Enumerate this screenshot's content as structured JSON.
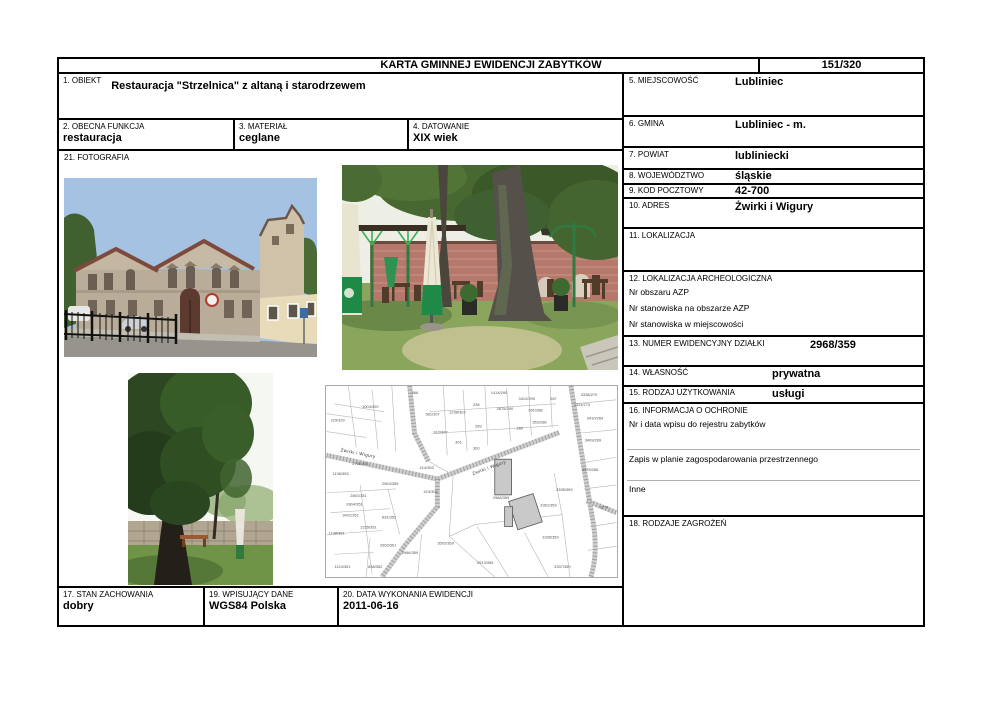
{
  "header": {
    "title": "KARTA GMINNEJ EWIDENCJI ZABYTKÓW",
    "page_number": "151/320"
  },
  "fields": {
    "obiekt": {
      "label": "1. OBIEKT",
      "value": "Restauracja \"Strzelnica\" z altaną i starodrzewem"
    },
    "obecna_funkcja": {
      "label": "2. OBECNA FUNKCJA",
      "value": "restauracja"
    },
    "material": {
      "label": "3. MATERIAŁ",
      "value": "ceglane"
    },
    "datowanie": {
      "label": "4. DATOWANIE",
      "value": "XIX wiek"
    },
    "miejscowosc": {
      "label": "5. MIEJSCOWOŚĆ",
      "value": "Lubliniec"
    },
    "gmina": {
      "label": "6. GMINA",
      "value": "Lubliniec - m."
    },
    "powiat": {
      "label": "7. POWIAT",
      "value": "lubliniecki"
    },
    "wojewodztwo": {
      "label": "8. WOJEWÓDZTWO",
      "value": "śląskie"
    },
    "kod_pocztowy": {
      "label": "9. KOD POCZTOWY",
      "value": "42-700"
    },
    "adres": {
      "label": "10. ADRES",
      "value": "Żwirki i Wigury"
    },
    "lokalizacja": {
      "label": "11. LOKALIZACJA",
      "value": ""
    },
    "lokalizacja_archeologiczna": {
      "label": "12. LOKALIZACJA ARCHEOLOGICZNA",
      "lines": [
        "Nr obszaru AZP",
        "Nr stanowiska na obszarze AZP",
        "Nr stanowiska w miejscowości"
      ]
    },
    "numer_dzialki": {
      "label": "13. NUMER EWIDENCYJNY DZIAŁKI",
      "value": "2968/359"
    },
    "wlasnosc": {
      "label": "14. WŁASNOŚĆ",
      "value": "prywatna"
    },
    "rodzaj_uzytkowania": {
      "label": "15. RODZAJ UŻYTKOWANIA",
      "value": "usługi"
    },
    "informacja_o_ochronie": {
      "label": "16. INFORMACJA O OCHRONIE",
      "lines": [
        "Nr i data wpisu do rejestru zabytków",
        "Zapis w planie zagospodarowania przestrzennego",
        "Inne"
      ]
    },
    "stan_zachowania": {
      "label": "17. STAN ZACHOWANIA",
      "value": "dobry"
    },
    "rodzaje_zagrozen": {
      "label": "18. RODZAJE ZAGROŻEŃ",
      "value": ""
    },
    "wpisujacy_dane": {
      "label": "19. WPISUJĄCY DANE",
      "value": "WGS84 Polska"
    },
    "data_wykonania": {
      "label": "20. DATA WYKONANIA EWIDENCJI",
      "value": "2011-06-16"
    },
    "fotografia": {
      "label": "21. FOTOGRAFIA"
    }
  },
  "photos": {
    "building": {
      "alt": "Restaurant Strzelnica building exterior"
    },
    "garden": {
      "alt": "Beer garden with umbrellas, brick wall and old trees"
    },
    "tree": {
      "alt": "Old tree with concrete fence"
    },
    "map": {
      "alt": "Cadastral map, parcel 2968/359"
    }
  },
  "map": {
    "street_labels": [
      {
        "t": "Żwirki i Wigury",
        "x": 14,
        "y": 66,
        "r": 11
      },
      {
        "t": "Żwirki i Wigury",
        "x": 148,
        "y": 90,
        "r": -20
      }
    ],
    "parcel_labels": [
      {
        "t": "386",
        "x": 86,
        "y": 8
      },
      {
        "t": "1414/290",
        "x": 166,
        "y": 8
      },
      {
        "t": "3412/290",
        "x": 194,
        "y": 14
      },
      {
        "t": "287",
        "x": 226,
        "y": 14
      },
      {
        "t": "3338/270",
        "x": 257,
        "y": 10
      },
      {
        "t": "1311/270",
        "x": 250,
        "y": 20
      },
      {
        "t": "2875/290",
        "x": 172,
        "y": 24
      },
      {
        "t": "238",
        "x": 148,
        "y": 20
      },
      {
        "t": "1004/300",
        "x": 36,
        "y": 22
      },
      {
        "t": "229/329",
        "x": 4,
        "y": 36
      },
      {
        "t": "581/307",
        "x": 100,
        "y": 30
      },
      {
        "t": "1238/302",
        "x": 124,
        "y": 28
      },
      {
        "t": "951/288",
        "x": 204,
        "y": 26
      },
      {
        "t": "952/288",
        "x": 208,
        "y": 38
      },
      {
        "t": "3410/269",
        "x": 263,
        "y": 34
      },
      {
        "t": "912/307",
        "x": 108,
        "y": 48
      },
      {
        "t": "299",
        "x": 150,
        "y": 42
      },
      {
        "t": "289",
        "x": 192,
        "y": 44
      },
      {
        "t": "301",
        "x": 130,
        "y": 58
      },
      {
        "t": "300",
        "x": 148,
        "y": 64
      },
      {
        "t": "3409/269",
        "x": 261,
        "y": 56
      },
      {
        "t": "2756/351",
        "x": 26,
        "y": 80
      },
      {
        "t": "1136/353",
        "x": 6,
        "y": 90
      },
      {
        "t": "414/353",
        "x": 94,
        "y": 84
      },
      {
        "t": "413/304",
        "x": 98,
        "y": 108
      },
      {
        "t": "2963/359",
        "x": 56,
        "y": 100
      },
      {
        "t": "2968/359",
        "x": 168,
        "y": 114
      },
      {
        "t": "3361/359",
        "x": 216,
        "y": 122
      },
      {
        "t": "3375/266",
        "x": 258,
        "y": 86
      },
      {
        "t": "3395/359",
        "x": 232,
        "y": 106
      },
      {
        "t": "3274",
        "x": 276,
        "y": 124
      },
      {
        "t": "2801/351",
        "x": 24,
        "y": 112
      },
      {
        "t": "2804/351",
        "x": 20,
        "y": 121
      },
      {
        "t": "3401/351",
        "x": 16,
        "y": 132
      },
      {
        "t": "1235/351",
        "x": 34,
        "y": 144
      },
      {
        "t": "832/352",
        "x": 56,
        "y": 134
      },
      {
        "t": "1138/351",
        "x": 2,
        "y": 150
      },
      {
        "t": "3336/359",
        "x": 218,
        "y": 154
      },
      {
        "t": "3502/359",
        "x": 112,
        "y": 160
      },
      {
        "t": "2966/359",
        "x": 76,
        "y": 170
      },
      {
        "t": "2963/361",
        "x": 54,
        "y": 162
      },
      {
        "t": "2913/359",
        "x": 152,
        "y": 180
      },
      {
        "t": "3337/359",
        "x": 230,
        "y": 184
      },
      {
        "t": "1124/351",
        "x": 8,
        "y": 184
      },
      {
        "t": "838/352",
        "x": 42,
        "y": 184
      }
    ]
  }
}
